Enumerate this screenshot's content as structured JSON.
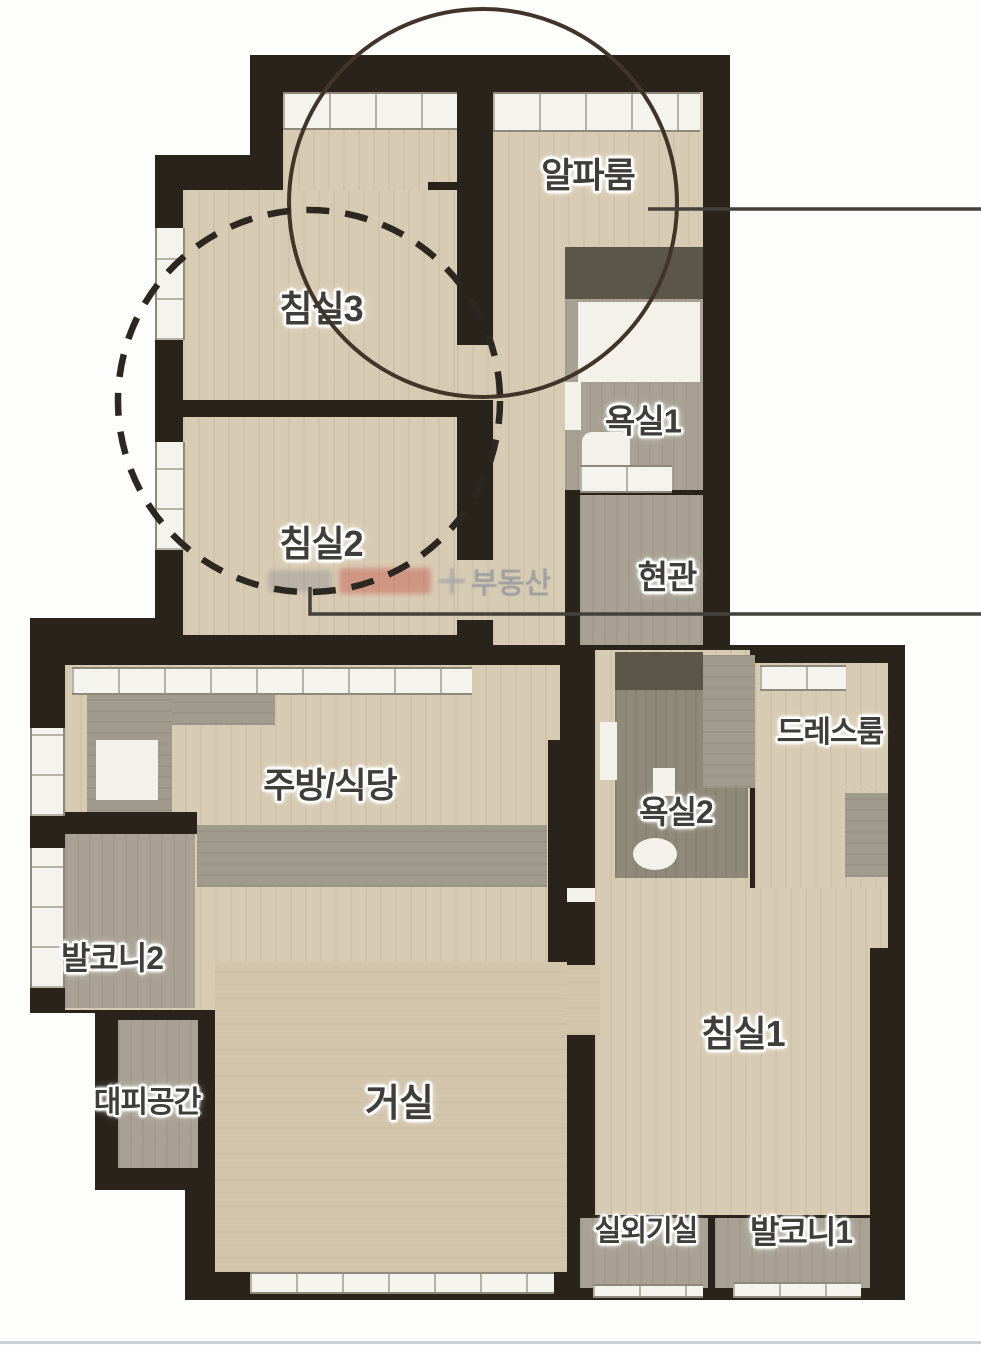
{
  "plan_type": "apartment-floor-plan",
  "rooms": [
    {
      "id": "alpha-room",
      "label": "알파룸"
    },
    {
      "id": "bedroom3",
      "label": "침실3"
    },
    {
      "id": "bathroom1",
      "label": "욕실1"
    },
    {
      "id": "bedroom2",
      "label": "침실2"
    },
    {
      "id": "entrance",
      "label": "현관"
    },
    {
      "id": "dress-room",
      "label": "드레스룸"
    },
    {
      "id": "kitchen-dining",
      "label": "주방/식당"
    },
    {
      "id": "bathroom2",
      "label": "욕실2"
    },
    {
      "id": "balcony2",
      "label": "발코니2"
    },
    {
      "id": "bedroom1",
      "label": "침실1"
    },
    {
      "id": "refuge-space",
      "label": "대피공간"
    },
    {
      "id": "living-room",
      "label": "거실"
    },
    {
      "id": "outdoor-unit-room",
      "label": "실외기실"
    },
    {
      "id": "balcony1",
      "label": "발코니1"
    }
  ],
  "watermark": {
    "text": "부동산"
  },
  "annotations": {
    "solid_circle_color": "#43342a",
    "dashed_circle_color": "#2d2721",
    "leader_line_color": "#45403a"
  },
  "palette": {
    "wall": "#2a231c",
    "floor_wood": "#d8cbb3",
    "wet_area": "#a9a294",
    "window": "#f5f3ee",
    "bottom_divider": "#ccd2d6"
  }
}
